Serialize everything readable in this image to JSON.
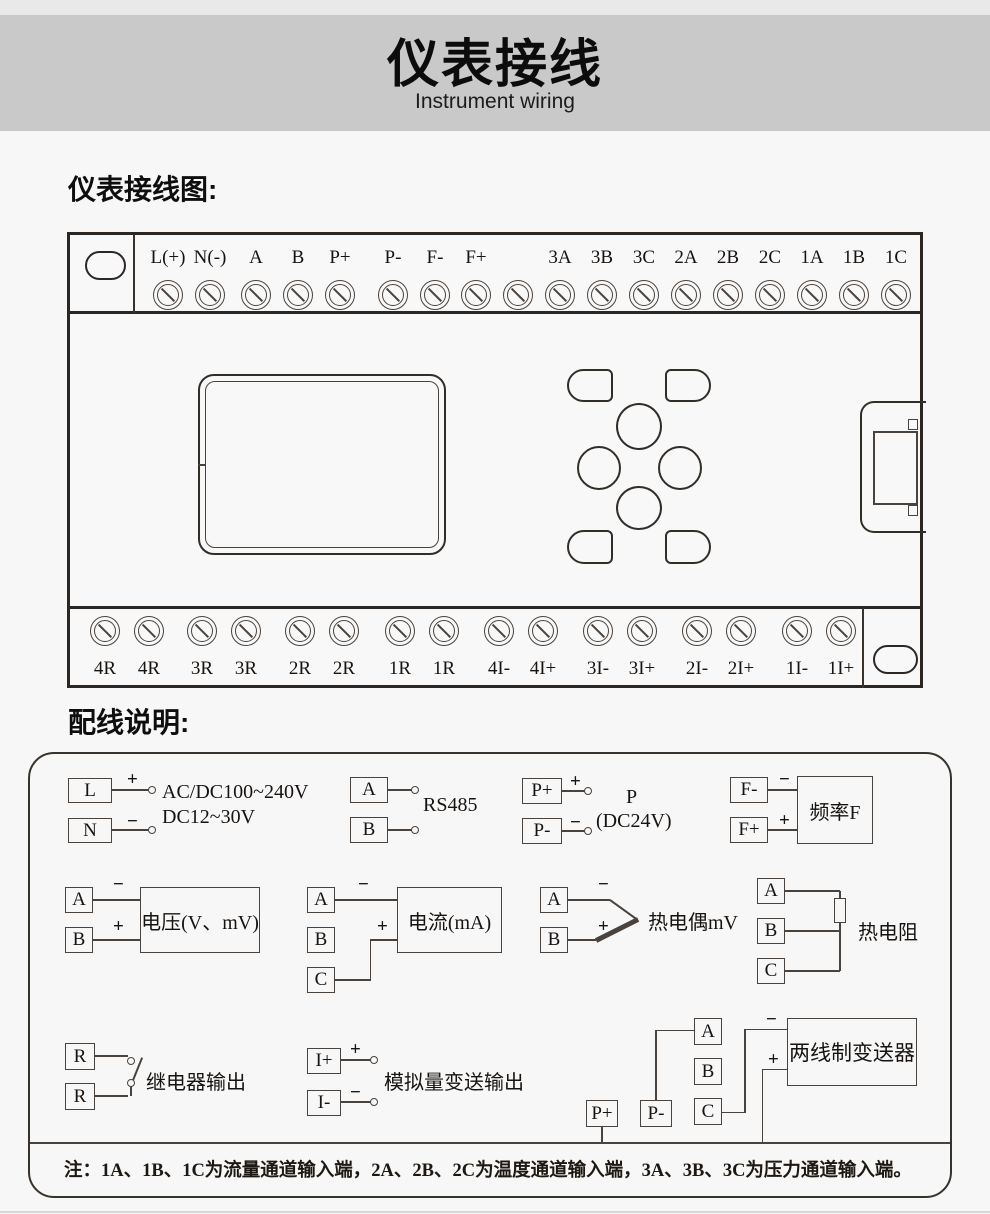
{
  "banner": {
    "title": "仪表接线",
    "subtitle": "Instrument wiring"
  },
  "sections": {
    "wiring_diagram_heading": "仪表接线图:",
    "wiring_notes_heading": "配线说明:"
  },
  "signs": {
    "plus": "+",
    "minus": "−"
  },
  "device": {
    "top_terminals": [
      "L(+)",
      "N(-)",
      "A",
      "B",
      "P+",
      "P-",
      "F-",
      "F+",
      "",
      "3A",
      "3B",
      "3C",
      "2A",
      "2B",
      "2C",
      "1A",
      "1B",
      "1C"
    ],
    "bottom_terminals": [
      "4R",
      "4R",
      "3R",
      "3R",
      "2R",
      "2R",
      "1R",
      "1R",
      "4I-",
      "4I+",
      "3I-",
      "3I+",
      "2I-",
      "2I+",
      "1I-",
      "1I+"
    ]
  },
  "wiring_groups": {
    "power": {
      "terminals": [
        "L",
        "N"
      ],
      "line1": "AC/DC100~240V",
      "line2": "DC12~30V"
    },
    "rs485": {
      "terminals": [
        "A",
        "B"
      ],
      "label": "RS485"
    },
    "power_out": {
      "terminals": [
        "P+",
        "P-"
      ],
      "label_line1": "P",
      "label_line2": "(DC24V)"
    },
    "frequency": {
      "terminals": [
        "F-",
        "F+"
      ],
      "box_label": "频率F"
    },
    "voltage": {
      "terminals": [
        "A",
        "B"
      ],
      "box_label": "电压(V、mV)"
    },
    "current": {
      "terminals": [
        "A",
        "B",
        "C"
      ],
      "box_label": "电流(mA)"
    },
    "thermocouple": {
      "terminals": [
        "A",
        "B"
      ],
      "label": "热电偶mV"
    },
    "rtd": {
      "terminals": [
        "A",
        "B",
        "C"
      ],
      "label": "热电阻"
    },
    "relay": {
      "terminals": [
        "R",
        "R"
      ],
      "label": "继电器输出"
    },
    "analog_out": {
      "terminals": [
        "I+",
        "I-"
      ],
      "label": "模拟量变送输出"
    },
    "transmitter": {
      "terminals": [
        "A",
        "B",
        "C",
        "P+",
        "P-"
      ],
      "box_label": "两线制变送器"
    }
  },
  "note": "注：1A、1B、1C为流量通道输入端，2A、2B、2C为温度通道输入端，3A、3B、3C为压力通道输入端。"
}
